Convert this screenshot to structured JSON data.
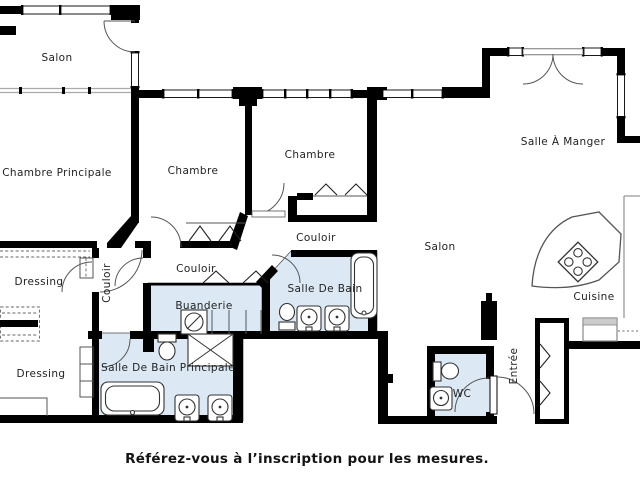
{
  "floorplan": {
    "rooms": [
      {
        "id": "salon-top",
        "label": "Salon"
      },
      {
        "id": "chambre-principale",
        "label": "Chambre Principale"
      },
      {
        "id": "chambre-1",
        "label": "Chambre"
      },
      {
        "id": "chambre-2",
        "label": "Chambre"
      },
      {
        "id": "salle-a-manger",
        "label": "Salle À Manger"
      },
      {
        "id": "couloir-upper",
        "label": "Couloir"
      },
      {
        "id": "couloir-mid",
        "label": "Couloir"
      },
      {
        "id": "couloir-vertical",
        "label": "Couloir"
      },
      {
        "id": "buanderie",
        "label": "Buanderie"
      },
      {
        "id": "salle-de-bain",
        "label": "Salle De Bain"
      },
      {
        "id": "salle-de-bain-principale",
        "label": "Salle De Bain Principale"
      },
      {
        "id": "dressing-1",
        "label": "Dressing"
      },
      {
        "id": "dressing-2",
        "label": "Dressing"
      },
      {
        "id": "salon-main",
        "label": "Salon"
      },
      {
        "id": "wc",
        "label": "WC"
      },
      {
        "id": "cuisine",
        "label": "Cuisine"
      },
      {
        "id": "entree",
        "label": "Entrée"
      }
    ],
    "caption": "Référez-vous à l’inscription pour les mesures.",
    "colors": {
      "wall": "#000000",
      "wet_room_fill": "#dce9f5",
      "line": "#4d4d4d",
      "background": "#ffffff",
      "label": "#1f1f1f"
    }
  }
}
